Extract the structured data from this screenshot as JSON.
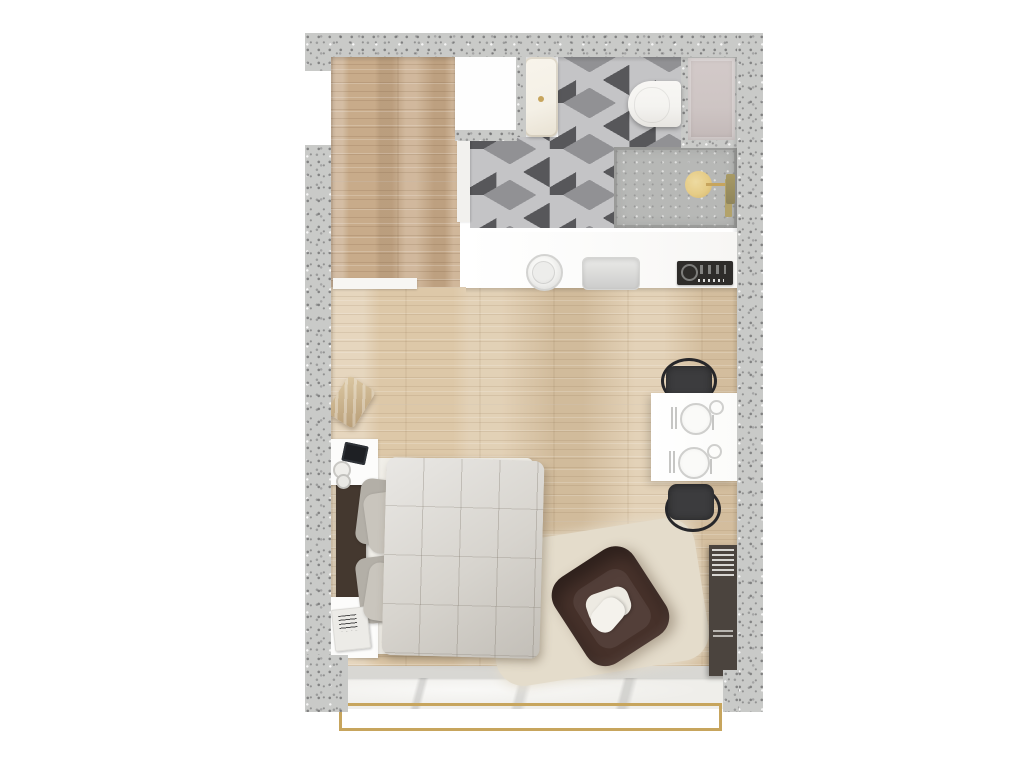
{
  "scene": {
    "type": "floor-plan",
    "description": "Top-down 3D rendered floor plan of a studio apartment with entry hallway, bathroom with isometric cube tile, kitchenette, combined living-sleeping room and a balcony with gold railing",
    "rooms": [
      {
        "id": "hallway",
        "label": "Entry hallway"
      },
      {
        "id": "bathroom",
        "label": "Bathroom"
      },
      {
        "id": "kitchen",
        "label": "Kitchenette"
      },
      {
        "id": "living",
        "label": "Living / sleeping area"
      },
      {
        "id": "balcony",
        "label": "Balcony"
      }
    ]
  },
  "labels": {
    "plan": "Studio apartment floor plan",
    "hallway": "Entry hallway",
    "entrance": "Entrance opening",
    "closet": "Closet",
    "bathtub": "Bathtub",
    "toilet": "Toilet",
    "shower": "Walk-in shower",
    "shower_head": "Rain shower head",
    "shower_valve": "Shower fittings",
    "bathroom_door": "Bathroom door",
    "door_panel": "Door",
    "tile_floor": "Cube tile bathroom floor",
    "kitchen_counter": "Kitchen counter",
    "kitchen_sink": "Round kitchen sink",
    "kitchen_basin": "Kitchen basin",
    "cooktop": "Cooktop",
    "main_floor": "Wood floor",
    "threshold": "Doorway threshold",
    "floor_cushion": "Floor cushion",
    "nightstand": "Nightstand",
    "tablet": "Tablet",
    "cup": "Cup",
    "magazines": "Magazines",
    "bed": "Bed",
    "headboard": "Headboard",
    "pillow": "Pillow",
    "duvet": "Quilted duvet",
    "rug": "Rug",
    "armchair": "Armchair",
    "cushion": "Cushion",
    "dining_table": "Dining table",
    "place_setting": "Place setting",
    "dining_chair": "Dining chair",
    "bookshelf": "Shelf unit",
    "window_sill": "Window sill",
    "balcony_floor": "Balcony floor",
    "railing": "Gold balcony railing",
    "wall": "Concrete wall"
  },
  "palette": {
    "wall": "#c9cac8",
    "wood-hall": "#c8ab8a",
    "wood-main": "#ddc8a8",
    "tile-dark": "#57575a",
    "tile-mid": "#919194",
    "tile-light": "#c4c4c6",
    "shower": "#b7b8b6",
    "gold": "#c7a55d",
    "gold-light": "#e8cd84",
    "fixture": "#f4f3f0",
    "counter": "#fcfcfb",
    "cooktop": "#2e2c2a",
    "mattress": "#f1efe9",
    "duvet": "#d7d4ce",
    "pillow-a": "#b3afa7",
    "pillow-b": "#c9c5bd",
    "headboard": "#44382f",
    "armchair": "#46312a",
    "rug": "#e4dccb",
    "chair": "#3c3c3e",
    "bookshelf": "#4b443e",
    "balcony": "#efeeea",
    "panel": "#cec5c4",
    "sill": "#d8d7d3",
    "threshold": "#f7f6f3",
    "tub": "#f4f0e6"
  }
}
